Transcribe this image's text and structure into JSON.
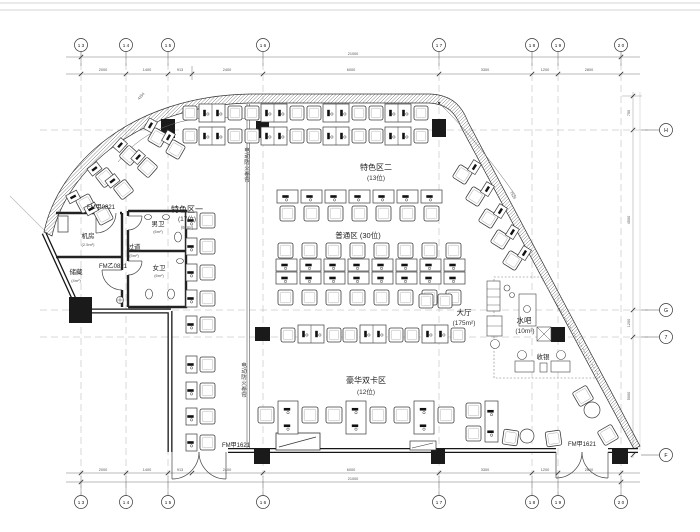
{
  "grid": {
    "top": [
      "1 3",
      "1 4",
      "1 5",
      "1 6",
      "1 7",
      "1 8",
      "1 9",
      "2 0"
    ],
    "bottom": [
      "1 3",
      "1 4",
      "1 5",
      "1 6",
      "1 7",
      "1 8",
      "1 9",
      "2 0"
    ],
    "right": [
      "H",
      "G",
      "7",
      "F"
    ]
  },
  "zones": {
    "tese1": {
      "name": "特色区一",
      "count": "(17位)",
      "area": "(67m²)"
    },
    "tese2": {
      "name": "特色区二",
      "count": "(13位)"
    },
    "putong": {
      "name": "普通区 (30位)"
    },
    "haohua": {
      "name": "豪华双卡区",
      "count": "(12位)"
    },
    "dating": {
      "name": "大厅",
      "area": "(175m²)"
    },
    "shuiba": {
      "name": "水吧",
      "area": "(10m²)"
    },
    "shouyin": {
      "name": "收银"
    },
    "jifang": {
      "name": "机房",
      "area": "(2.5m²)"
    },
    "guodao": {
      "name": "过道",
      "area": "(5m²)"
    },
    "nanwei": {
      "name": "男卫",
      "area": "(6m²)"
    },
    "nvwei": {
      "name": "女卫",
      "area": "(6m²)"
    },
    "chucang": {
      "name": "储藏",
      "area": "(4m²)"
    }
  },
  "doors": {
    "fm_jia_0821": "FM甲0821",
    "fm_yi_0821": "FM乙0821",
    "fm_jia_1621_left": "FM甲1621",
    "fm_jia_1621_right": "FM甲1621"
  },
  "labels": {
    "fire_shutter": "电动防火卷帘"
  },
  "dims": {
    "top": [
      "2000",
      "1400",
      "913",
      "2400",
      "6000",
      "3300",
      "1200",
      "2800"
    ],
    "top_overall": "21000",
    "bottom": [
      "2000",
      "1400",
      "913",
      "2400",
      "6000",
      "3300",
      "1200",
      "2800"
    ],
    "bottom_overall": "21000",
    "right": [
      "750",
      "4500",
      "1200",
      "5000"
    ],
    "radius_left": "4254",
    "radius_right": "7625"
  }
}
